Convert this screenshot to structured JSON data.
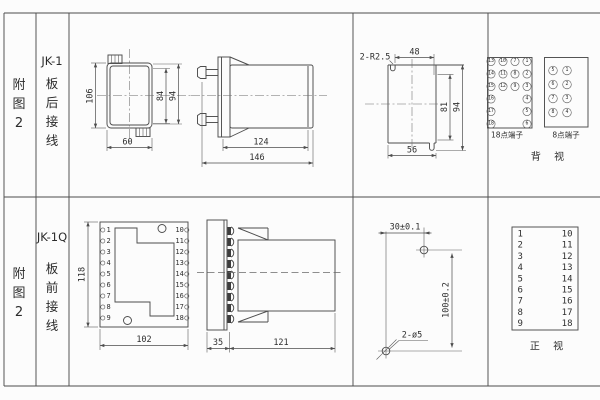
{
  "sheet": {
    "bg": "#fcfcfc",
    "line_color": "#4d4d4d",
    "text_color": "#2e2e2e"
  },
  "row1": {
    "fig_label": "附图2",
    "model": "JK-1",
    "wiring": "板后接线",
    "rear_view": {
      "dim_height": "106",
      "dim_inner_height": "84",
      "dim_outer_height": "94",
      "dim_width": "60"
    },
    "side_view": {
      "dim_body": "124",
      "dim_total": "146"
    },
    "cutout": {
      "radius_label": "2-R2.5",
      "dim_top": "48",
      "dim_inner_height": "81",
      "dim_height": "94",
      "dim_bottom": "56"
    },
    "terminal18": {
      "label": "18点端子",
      "col1": [
        "13",
        "14",
        "15",
        "16",
        "17",
        "18"
      ],
      "col2": [
        "10",
        "11",
        "12"
      ],
      "col3": [
        "7",
        "8",
        "9"
      ],
      "col4": [
        "1",
        "2",
        "3",
        "4",
        "5",
        "6"
      ]
    },
    "terminal8": {
      "label": "8点端子",
      "col1": [
        "5",
        "6",
        "7",
        "8"
      ],
      "col2": [
        "1",
        "2",
        "3",
        "4"
      ]
    },
    "view_label": "背 视"
  },
  "row2": {
    "fig_label": "附图2",
    "model": "JK-1Q",
    "wiring": "板前接线",
    "front_view": {
      "dim_height": "118",
      "dim_width": "102",
      "left_terminals": [
        "1",
        "2",
        "3",
        "4",
        "5",
        "6",
        "7",
        "8",
        "9"
      ],
      "right_terminals": [
        "10",
        "11",
        "12",
        "13",
        "14",
        "15",
        "16",
        "17",
        "18"
      ]
    },
    "side_view": {
      "dim_plate": "35",
      "dim_body": "121"
    },
    "drill_plan": {
      "dim_width": "30±0.1",
      "dim_height": "100±0.2",
      "hole_label": "2-ø5"
    },
    "terminal_table": {
      "left": [
        "1",
        "2",
        "3",
        "4",
        "5",
        "6",
        "7",
        "8",
        "9"
      ],
      "right": [
        "10",
        "11",
        "12",
        "13",
        "14",
        "15",
        "16",
        "17",
        "18"
      ]
    },
    "view_label": "正 视"
  }
}
